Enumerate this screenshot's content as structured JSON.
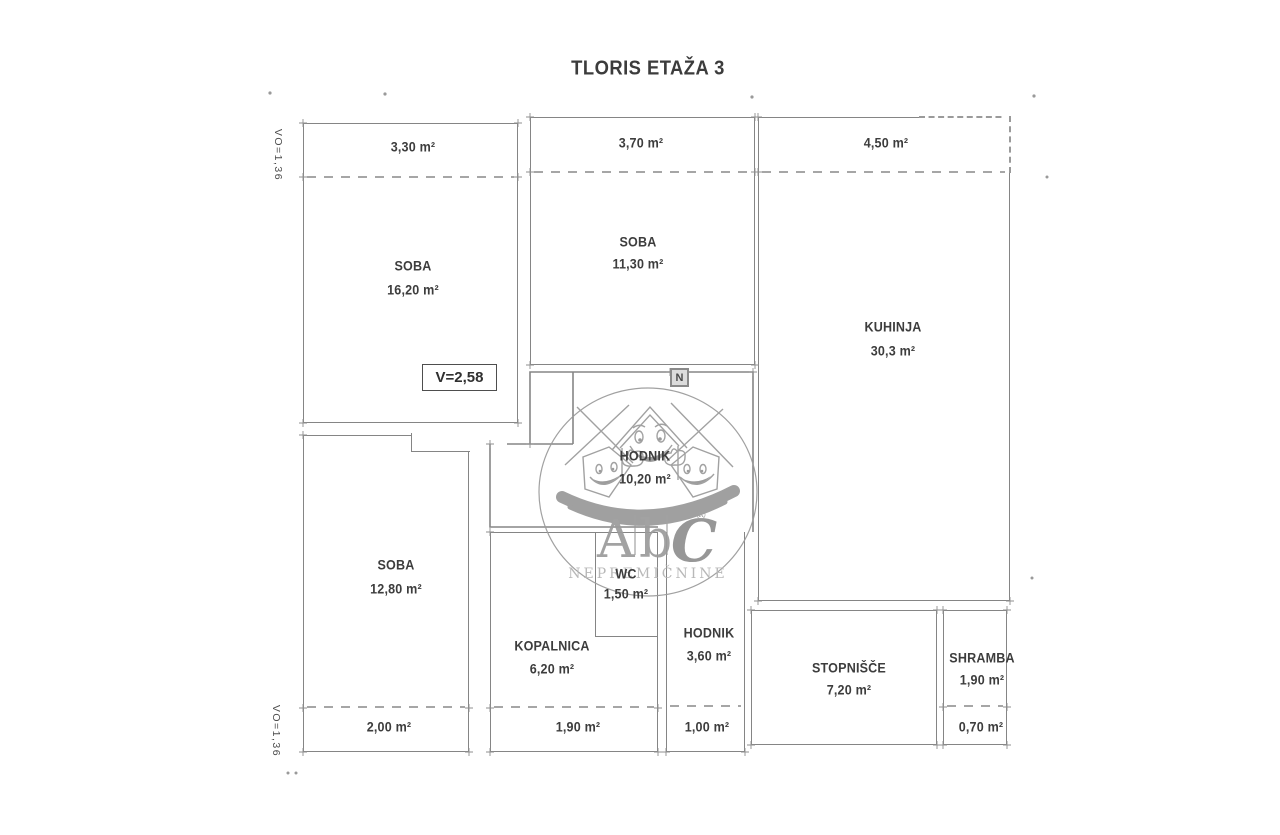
{
  "title": "TLORIS ETAŽA 3",
  "side_labels": {
    "top": "VO=1,36",
    "bottom": "VO=1,36"
  },
  "height_label": "V=2,58",
  "north_label": "N",
  "rooms": {
    "soba_top_left": {
      "name": "SOBA",
      "area": "16,20 m²",
      "balcony": "3,30 m²"
    },
    "soba_top_mid": {
      "name": "SOBA",
      "area": "11,30 m²",
      "balcony": "3,70 m²"
    },
    "kuhinja": {
      "name": "KUHINJA",
      "area": "30,3 m²",
      "balcony": "4,50 m²"
    },
    "hodnik_main": {
      "name": "HODNIK",
      "area": "10,20 m²"
    },
    "soba_bottom_left": {
      "name": "SOBA",
      "area": "12,80 m²",
      "balcony": "2,00 m²"
    },
    "kopalnica": {
      "name": "KOPALNICA",
      "area": "6,20 m²",
      "balcony": "1,90 m²"
    },
    "wc": {
      "name": "WC",
      "area": "1,50 m²"
    },
    "hodnik_lower": {
      "name": "HODNIK",
      "area": "3,60 m²",
      "balcony": "1,00 m²"
    },
    "stopnisce": {
      "name": "STOPNIŠČE",
      "area": "7,20 m²"
    },
    "shramba": {
      "name": "SHRAMBA",
      "area": "1,90 m²",
      "balcony": "0,70 m²"
    }
  },
  "watermark": {
    "letter_a": "A",
    "letter_b": "b",
    "letter_c": "C",
    "registered": "®",
    "subtitle": "NEPREMIČNINE"
  },
  "colors": {
    "wall": "#858585",
    "dashed": "#a6a6a6",
    "text": "#3d3d3d",
    "watermark": "#9a9a9a",
    "background": "#ffffff"
  }
}
